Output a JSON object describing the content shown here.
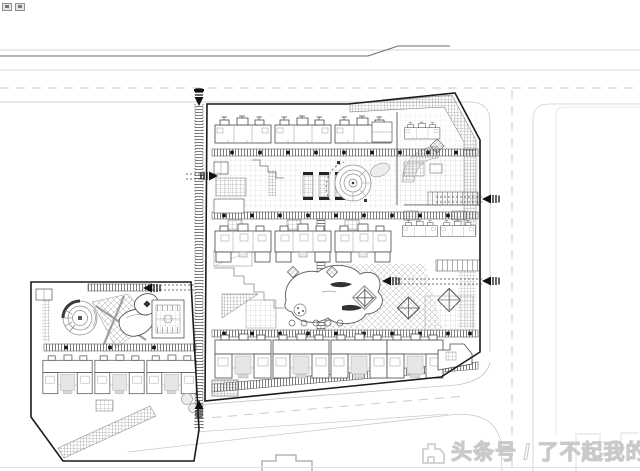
{
  "app": {
    "viewer_icons": [
      {
        "name": "image-thumbnail-icon"
      },
      {
        "name": "image-link-icon"
      }
    ]
  },
  "colors": {
    "background": "#ffffff",
    "ink_dark": "#1a1a1a",
    "ink_mid": "#555555",
    "road_light": "#c6c6c6",
    "hatch_gray": "#9b9b9b",
    "watermark_fill": "#ffffff",
    "watermark_outline": "#c9c9c9"
  },
  "watermark": {
    "text": "头条号 / 了不起我的家",
    "logo": "toutiao-house-logo"
  },
  "plan": {
    "kind": "residential community site plan (CAD line drawing)",
    "parcels": [
      {
        "name": "main-parcel"
      },
      {
        "name": "west-parcel"
      }
    ],
    "roads": [
      {
        "name": "north-road"
      },
      {
        "name": "east-road"
      },
      {
        "name": "south-road"
      },
      {
        "name": "west-access-lane"
      }
    ],
    "entrance_count": 7,
    "features": [
      "townhouse-rows",
      "central-pond",
      "round-plaza",
      "spiral-garden",
      "lattice-plaza",
      "sports-court",
      "paved-walkways",
      "corner-hatch-paving"
    ]
  }
}
